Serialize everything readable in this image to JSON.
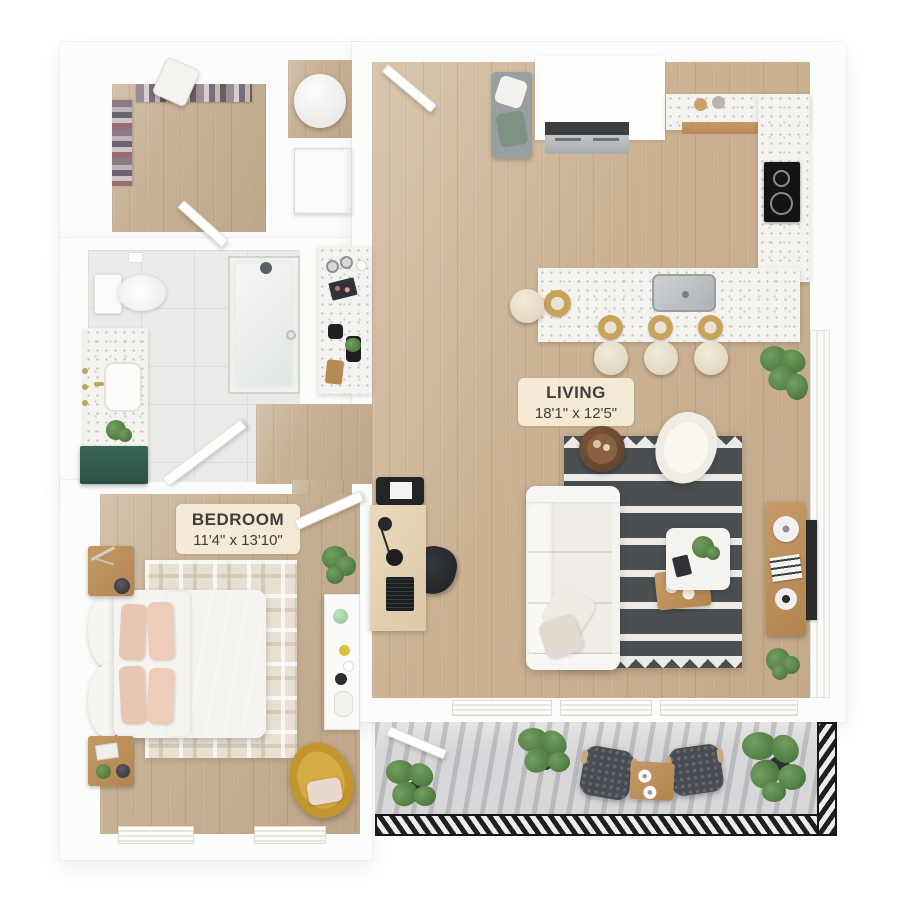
{
  "rooms": {
    "living": {
      "label": "LIVING",
      "dimensions": "18'1\" x 12'5\"",
      "fixtures": [
        "sofa",
        "area-rug",
        "side-table",
        "accent-chair",
        "ottoman-coffee-table",
        "media-console",
        "tv",
        "desk",
        "office-chair",
        "potted-plants"
      ]
    },
    "bedroom": {
      "label": "BEDROOM",
      "dimensions": "11'4\" x 13'10\"",
      "fixtures": [
        "bed",
        "nightstand-top",
        "nightstand-bottom",
        "plaid-rug",
        "dresser",
        "lounge-chair",
        "potted-plant",
        "windows"
      ]
    },
    "kitchen": {
      "fixtures": [
        "refrigerator",
        "wall-counter",
        "cooktop",
        "island",
        "island-sink",
        "bar-stools",
        "place-settings"
      ]
    },
    "bathroom": {
      "fixtures": [
        "toilet",
        "walk-in-shower",
        "vanity-sink",
        "green-vanity-cabinet",
        "counter-nook"
      ]
    },
    "walk_in_closet": {
      "fixtures": [
        "hanging-clothes",
        "laundry-basket",
        "closet-door"
      ]
    },
    "laundry": {
      "fixtures": [
        "water-heater",
        "washer-dryer"
      ]
    },
    "entry": {
      "fixtures": [
        "entry-door",
        "entry-bench"
      ]
    },
    "balcony": {
      "fixtures": [
        "patio-chair",
        "patio-chair",
        "patio-table",
        "potted-plants",
        "railing",
        "balcony-door"
      ]
    }
  },
  "colors": {
    "wall": "#fcfcfb",
    "wood_floor": "#cbb293",
    "tile_floor": "#eaeae8",
    "balcony_concrete": "#d7d7d9",
    "area_rug_dark": "#4a4f52",
    "area_rug_light": "#ecebe7",
    "bedroom_rug": "#e8e1d3",
    "bedding_blush": "#eaccbc",
    "vanity_green": "#31594a",
    "lounge_chair_mustard": "#c79a33",
    "counter_marble": "#f3f2ef",
    "plant_green": "#55804a",
    "appliance_steel": "#b5b8ba",
    "cooktop_black": "#161616",
    "label_bg": "#f6eedc",
    "label_text": "#403e39",
    "railing_black": "#1f1f1f"
  }
}
